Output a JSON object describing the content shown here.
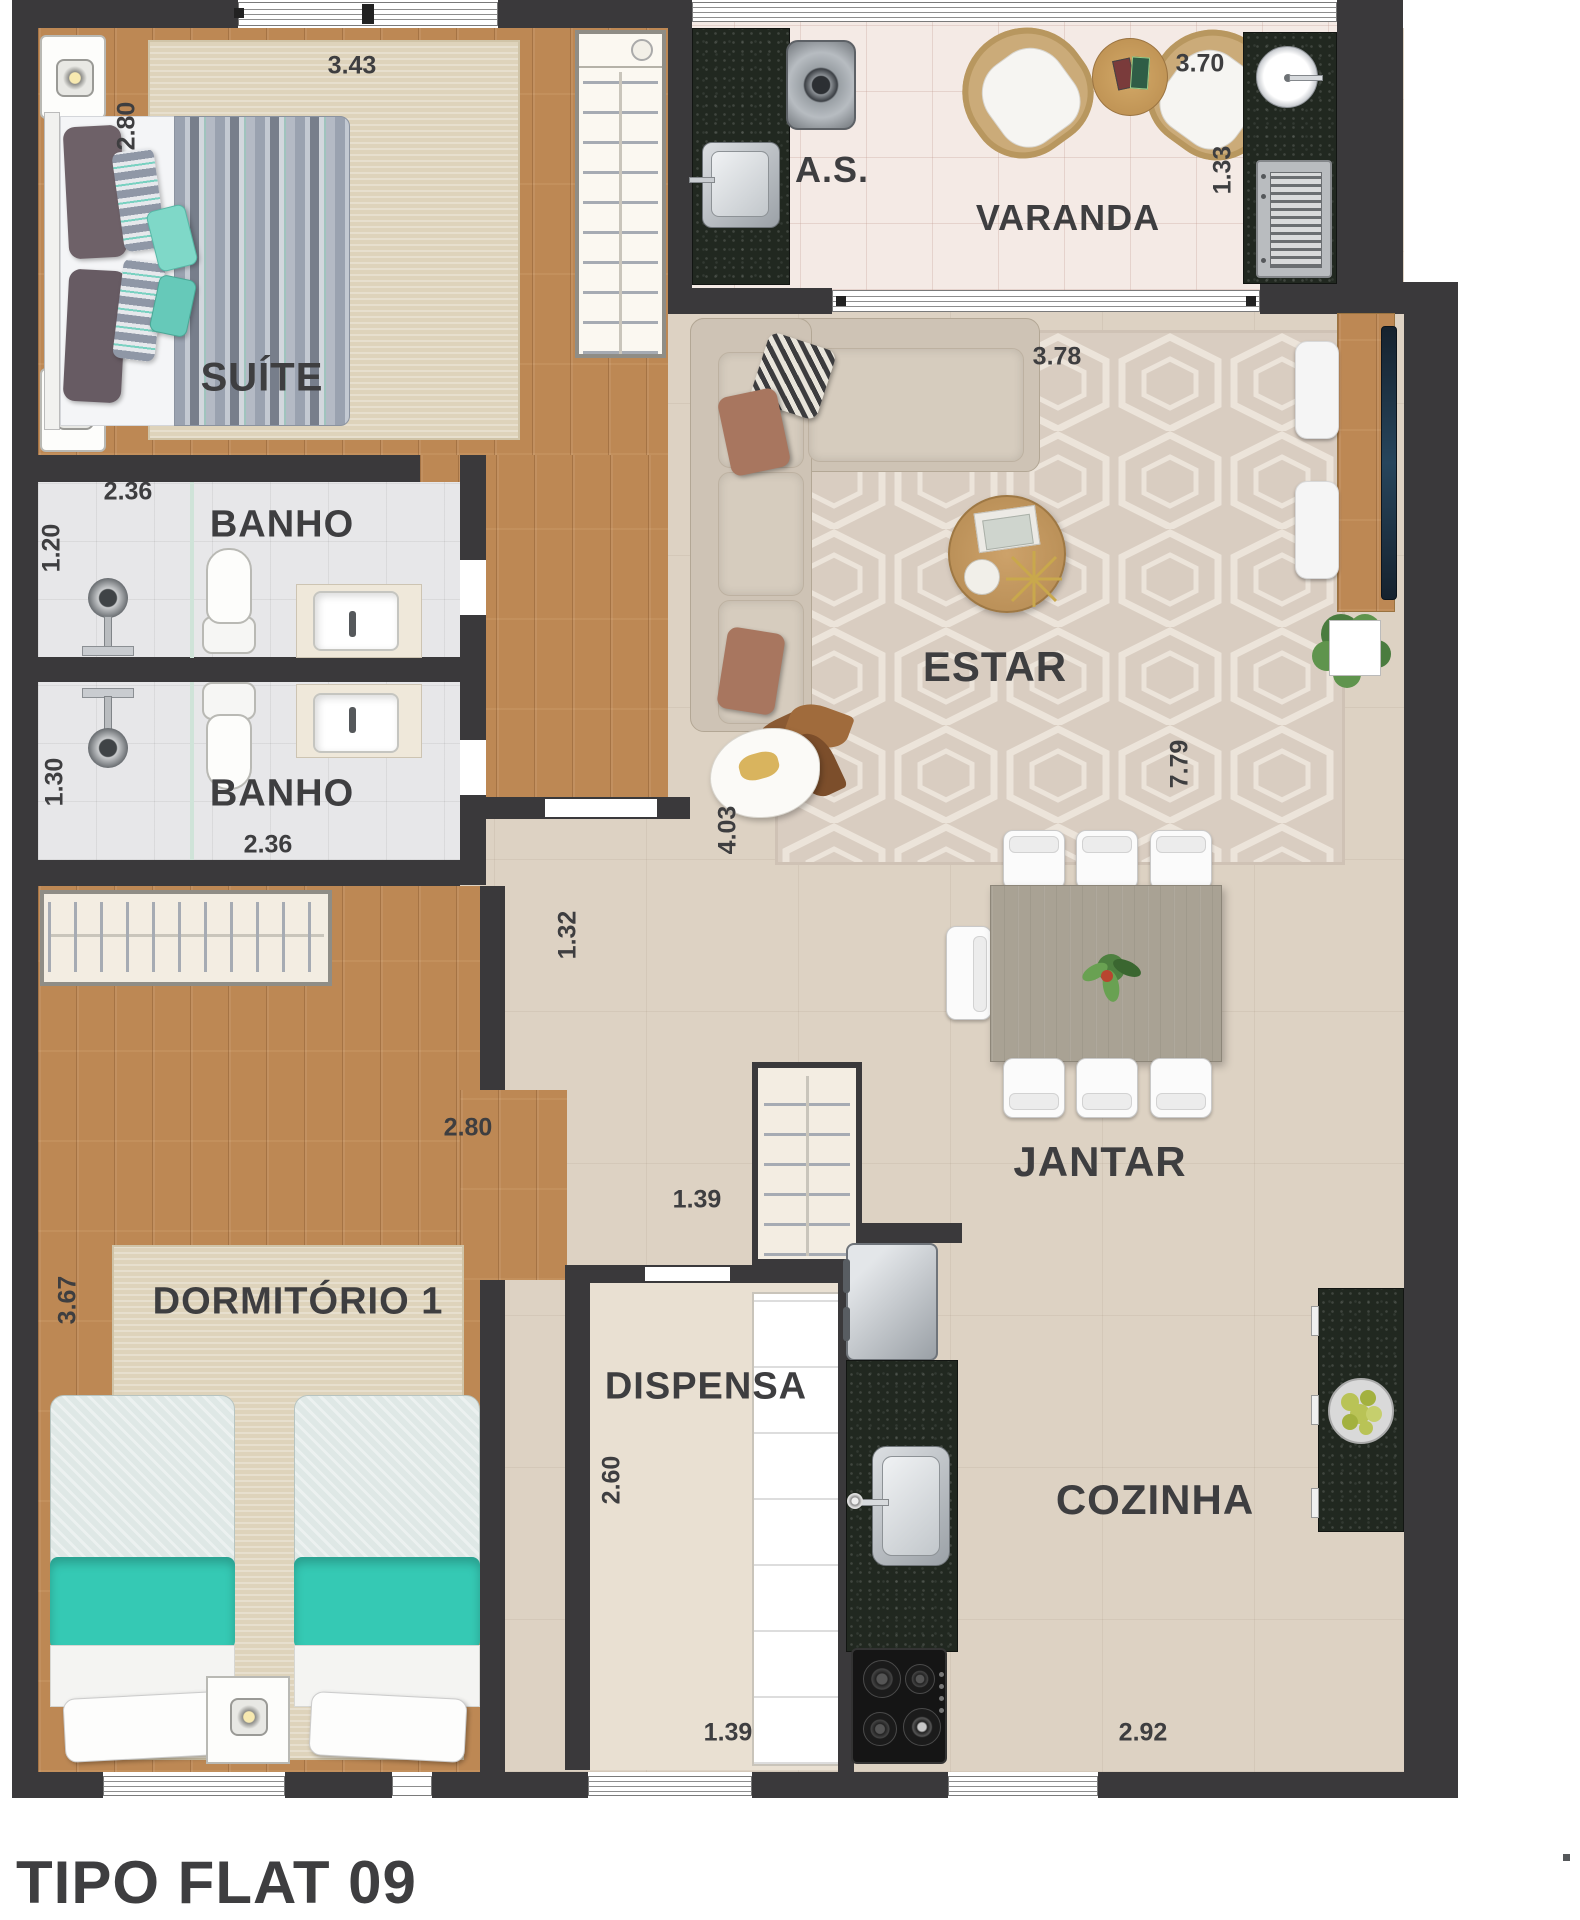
{
  "title": "TIPO FLAT 09",
  "colors": {
    "wall": "#3a393b",
    "wood_floor": "#c18b56",
    "tile_floor": "#ddd2c3",
    "granite_counter": "#212820",
    "teal_accent": "#5fcdbd",
    "label_text": "#3e3e40"
  },
  "rooms": {
    "suite": {
      "label": "SUÍTE",
      "dim_w": "3.43",
      "dim_h": "2.80"
    },
    "banho_suite": {
      "label": "BANHO",
      "dim_w": "2.36",
      "dim_h": "1.20"
    },
    "banho_social": {
      "label": "BANHO",
      "dim_w": "2.36",
      "dim_h": "1.30"
    },
    "dormitorio": {
      "label": "DORMITÓRIO 1",
      "dim_h": "3.67",
      "dim_entry": "2.80"
    },
    "area_servico": {
      "label": "A.S."
    },
    "varanda": {
      "label": "VARANDA",
      "dim_w": "3.70",
      "dim_h": "1.33"
    },
    "estar": {
      "label": "ESTAR",
      "dim_w": "3.78",
      "dim_len": "7.79",
      "dim_side": "4.03"
    },
    "hall": {
      "dim_w": "1.32",
      "dim_pass": "1.39"
    },
    "dispensa": {
      "label": "DISPENSA",
      "dim_h": "2.60",
      "dim_w": "1.39"
    },
    "jantar": {
      "label": "JANTAR"
    },
    "cozinha": {
      "label": "COZINHA",
      "dim_w": "2.92"
    }
  }
}
